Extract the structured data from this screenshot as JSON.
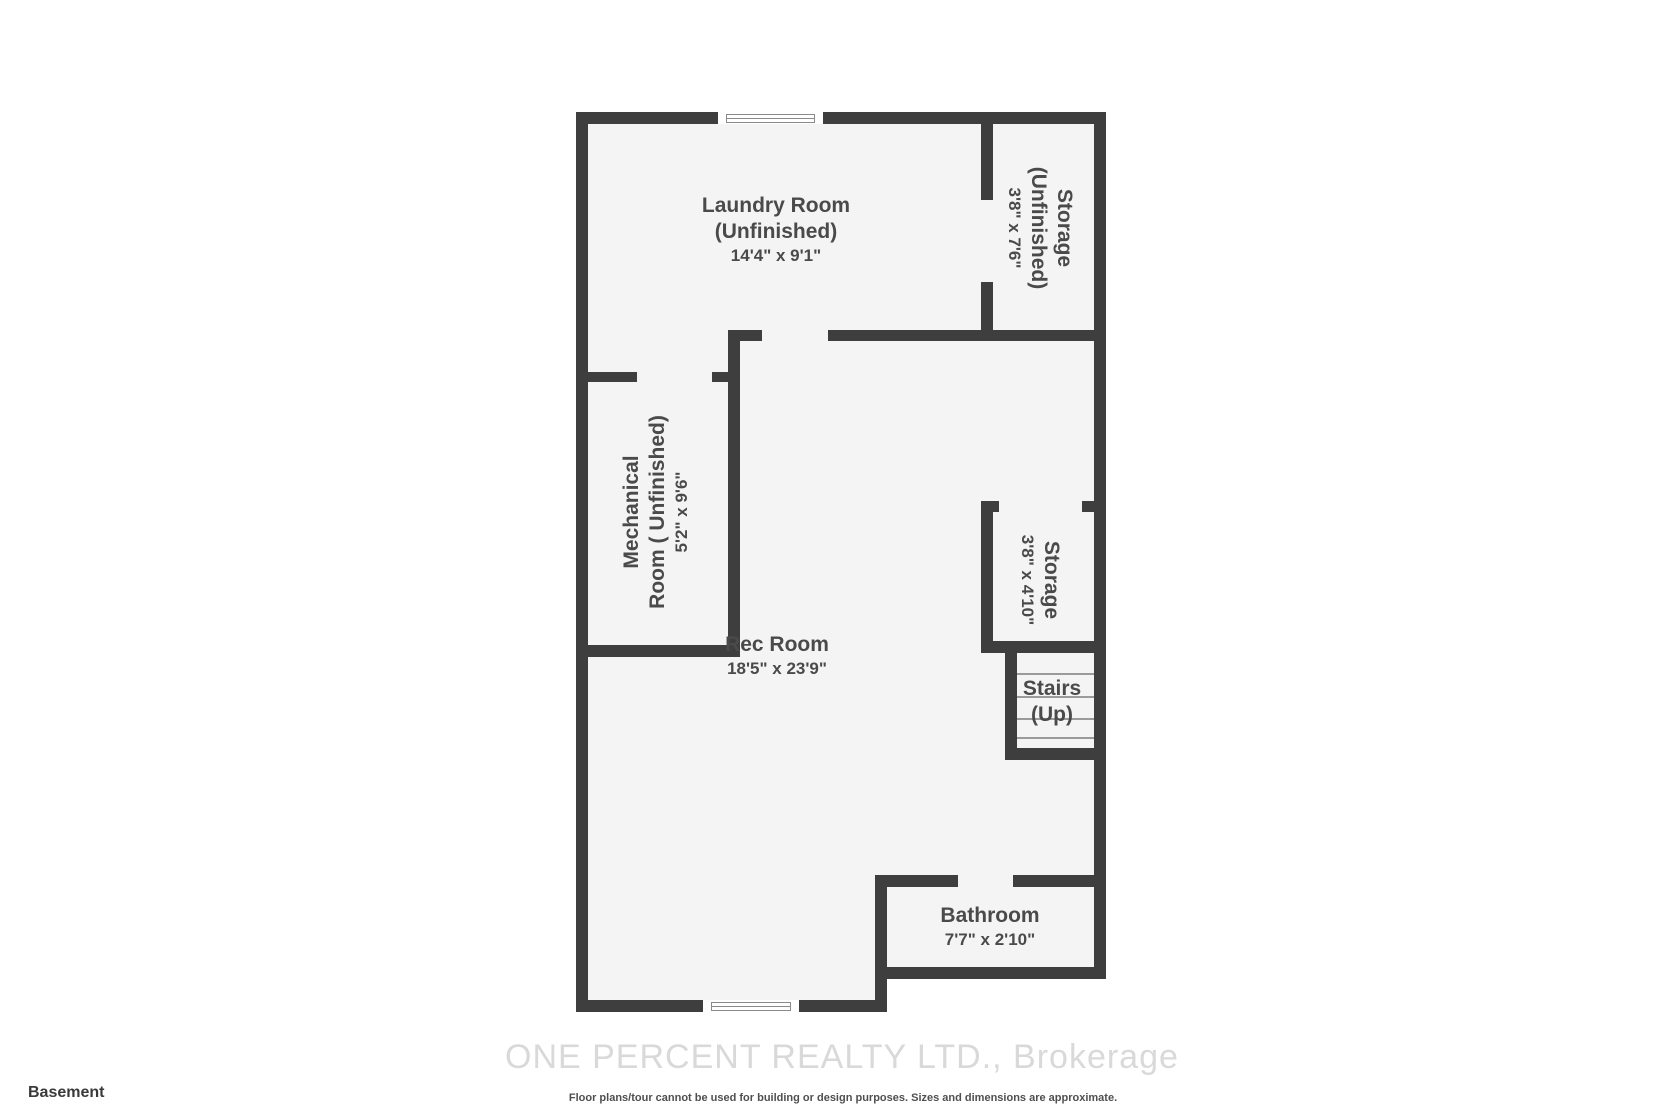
{
  "floorplan": {
    "floor_label": "Basement",
    "watermark": "ONE PERCENT REALTY LTD., Brokerage",
    "disclaimer": "Floor plans/tour cannot be used for building or design purposes. Sizes and dimensions are approximate.",
    "colors": {
      "wall": "#3e3e3e",
      "room_fill": "#f4f4f4",
      "label_text": "#4a4a4a",
      "watermark_text": "#d9d9d9"
    },
    "rooms": {
      "laundry": {
        "name": "Laundry Room",
        "qualifier": "(Unfinished)",
        "dims": "14'4\" x 9'1\""
      },
      "storage_top": {
        "name": "Storage",
        "qualifier": "(Unfinished)",
        "dims": "3'8\" x 7'6\""
      },
      "mechanical": {
        "name_line1": "Mechanical",
        "name_line2": "Room ( Unfinished)",
        "dims": "5'2\" x 9'6\""
      },
      "rec_room": {
        "name": "Rec Room",
        "dims": "18'5\" x 23'9\""
      },
      "storage_mid": {
        "name": "Storage",
        "dims": "3'8\" x 4'10\""
      },
      "stairs": {
        "name": "Stairs",
        "qualifier": "(Up)"
      },
      "bathroom": {
        "name": "Bathroom",
        "dims": "7'7\" x 2'10\""
      }
    }
  }
}
